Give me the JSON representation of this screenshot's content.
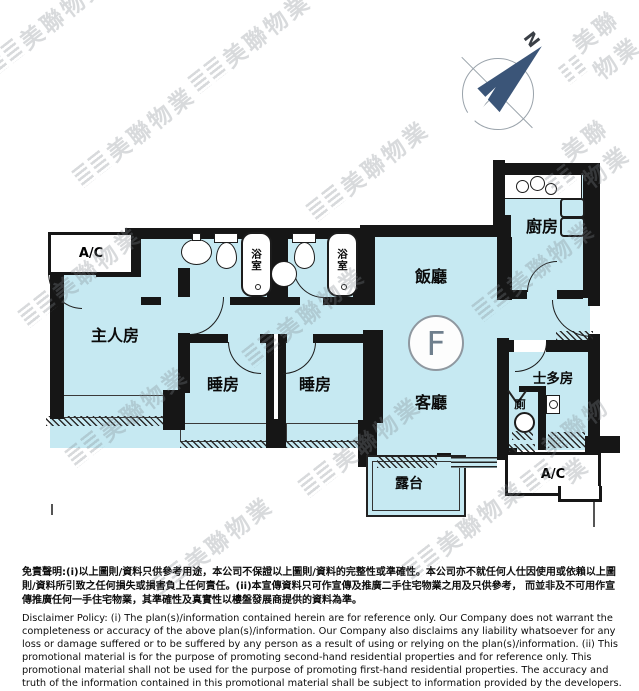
{
  "watermark": {
    "text": "美聯物業"
  },
  "compass": {
    "north_label": "N",
    "needle_color": "#3b5578"
  },
  "floor_plan": {
    "unit_label": "F",
    "colors": {
      "floor": "#c6e9f2",
      "wall": "#161616"
    },
    "labels": {
      "ac_top_left": "A/C",
      "ac_bottom_right": "A/C",
      "master_bedroom": "主人房",
      "bedroom_left": "睡房",
      "bedroom_right": "睡房",
      "bathroom_left": "浴室",
      "bathroom_right": "浴室",
      "dining_room": "飯廳",
      "living_room": "客廳",
      "kitchen": "廚房",
      "store_room": "士多房",
      "toilet": "廁",
      "balcony": "露台"
    }
  },
  "disclaimer": {
    "chinese": "免責聲明:(i)以上圖則/資料只供參考用途，本公司不保證以上圖則/資料的完整性或準確性。本公司亦不就任何人仕因使用或依賴以上圖則/資料所引致之任何損失或損害負上任何責任。(ii)本宣傳資料只可作宣傳及推廣二手住宅物業之用及只供參考， 而並非及不可用作宣傳推廣任何一手住宅物業，其準確性及真實性以樓盤發展商提供的資料為準。",
    "english": "Disclaimer Policy: (i) The plan(s)/information contained herein are for reference only. Our Company does not warrant the completeness or accuracy of the above plan(s)/information. Our Company also disclaims any liability whatsoever for any loss or damage suffered or to be suffered by any person as a result of using or relying on the plan(s)/information. (ii) This promotional material is for the purpose of promoting second-hand residential properties and for reference only. This promotional material shall not be used for the purpose of promoting first-hand residential properties. The accuracy and truth of the information contained in this promotional material shall be subject to information provided by the developers."
  }
}
